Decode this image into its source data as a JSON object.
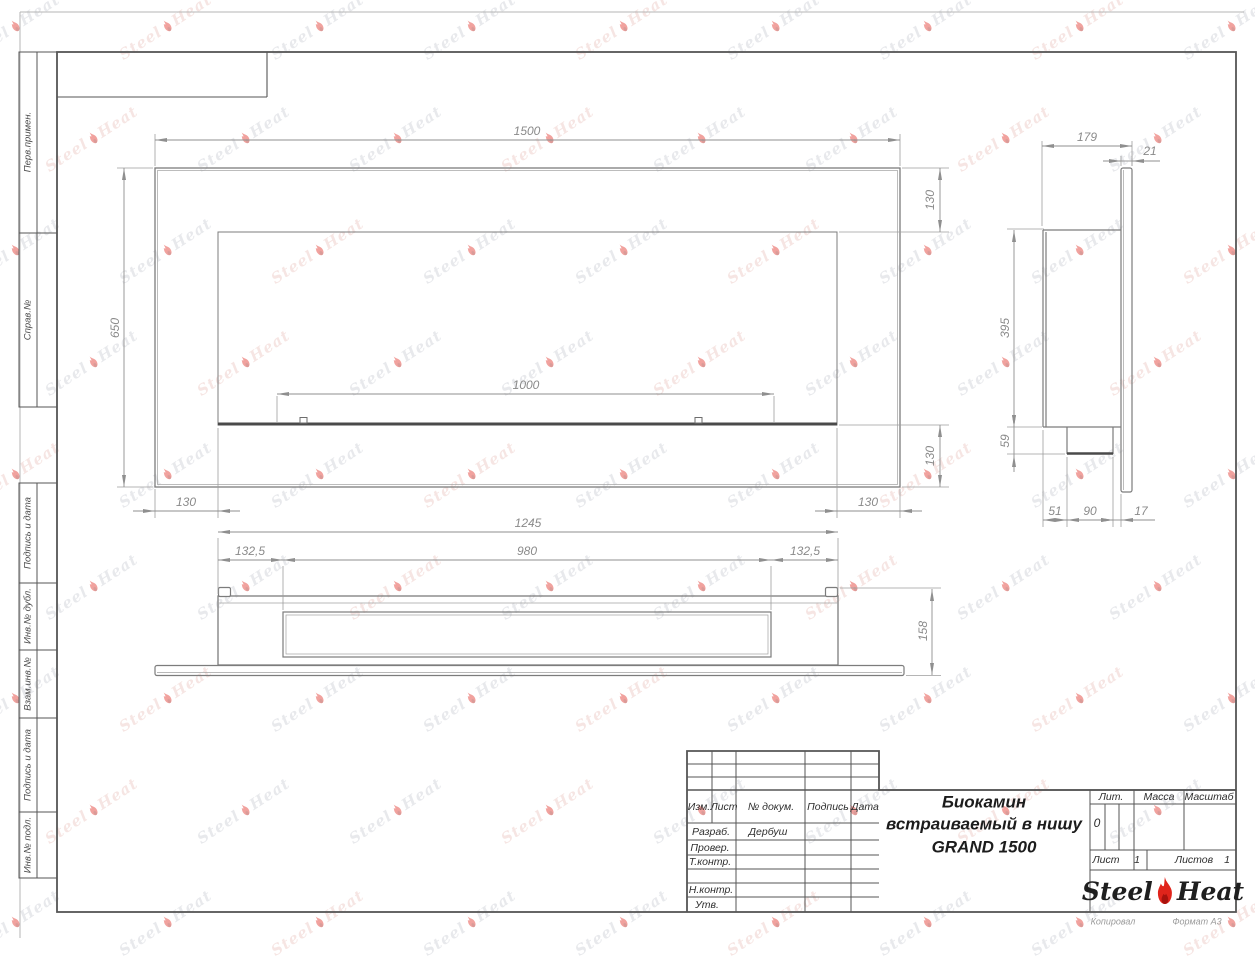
{
  "watermark": {
    "steel": "Steel",
    "heat": "Heat"
  },
  "margin_stamps": [
    "Перв.примен.",
    "Справ.№",
    "Подпись и дата",
    "Инв.№ дубл.",
    "Взам.инв.№",
    "Подпись и дата",
    "Инв.№ подл."
  ],
  "title_block": {
    "header": {
      "change": "Изм.",
      "sheet": "Лист",
      "doc": "№ докум.",
      "sign": "Подпись",
      "date": "Дата"
    },
    "rows": [
      {
        "role": "Разраб.",
        "value": "Дербуш"
      },
      {
        "role": "Провер.",
        "value": ""
      },
      {
        "role": "Т.контр.",
        "value": ""
      },
      {
        "role": "Н.контр.",
        "value": ""
      },
      {
        "role": "Утв.",
        "value": ""
      }
    ],
    "title": {
      "line1": "Биокамин",
      "line2": "встраиваемый в нишу",
      "line3": "GRAND 1500"
    },
    "lit": {
      "label": "Лит.",
      "value": "0"
    },
    "mass": {
      "label": "Масса"
    },
    "scale": {
      "label": "Масштаб"
    },
    "sheet": {
      "label": "Лист",
      "value": "1"
    },
    "sheets": {
      "label": "Листов",
      "value": "1"
    },
    "logo": {
      "steel": "Steel",
      "heat": "Heat"
    }
  },
  "footer": {
    "copy": "Копировал",
    "format": "Формат А3"
  },
  "dims": {
    "front_width": "1500",
    "front_height": "650",
    "front_top_margin": "130",
    "front_bottom_margin": "130",
    "burner_length": "1000",
    "front_left_margin": "130",
    "front_right_margin": "130",
    "insert_width": "1245",
    "insert_left_offset": "132,5",
    "insert_opening": "980",
    "insert_right_offset": "132,5",
    "insert_height": "158",
    "side_depth": "179",
    "side_frame_thickness": "21",
    "side_height": "395",
    "side_tray_height": "59",
    "side_back_offset": "51",
    "side_tray_width": "90",
    "side_gap": "17"
  },
  "colors": {
    "accent_red": "#e0241b",
    "line_gray": "#7c7c7c",
    "dim_gray": "#8f8f8f"
  }
}
